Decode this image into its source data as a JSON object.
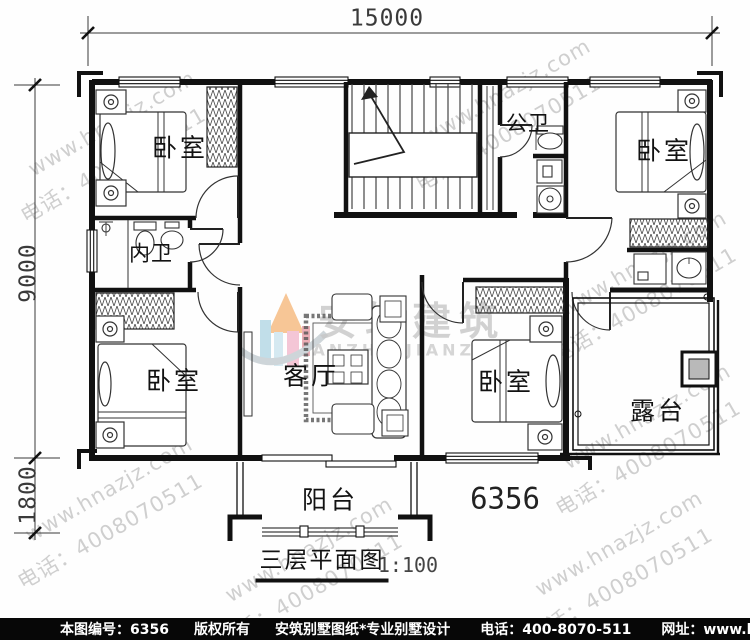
{
  "dimensions": {
    "top_width": "15000",
    "left_height": "9000",
    "left_lower": "1800"
  },
  "rooms": {
    "bedroom_top_left": "卧室",
    "bedroom_top_right": "卧室",
    "bedroom_mid_left": "卧室",
    "bedroom_bottom_right": "卧室",
    "living_room": "客厅",
    "bath_inner": "内卫",
    "bath_public": "公卫",
    "balcony": "阳台",
    "terrace": "露台"
  },
  "plan": {
    "number": "6356",
    "title": "三层平面图",
    "scale": "1:100"
  },
  "watermark": {
    "url": "www.hnazjz.com",
    "phone": "电话：4008070511",
    "brand_cn": "安筑建筑",
    "brand_en": "ANZHU JIANZHU"
  },
  "footer": {
    "doc_no": "本图编号：6356",
    "copyright": "版权所有",
    "studio": "安筑别墅图纸*专业别墅设计",
    "phone": "电话：400-8070-511",
    "website": "网址：www.hnazjz.com"
  },
  "colors": {
    "wall": "#111111",
    "footer_bg": "#070707",
    "watermark_gray": "#a9a9a9",
    "logo_blue": "#b7d9e6",
    "logo_pink": "#f3bdd0",
    "logo_orange": "#f6bd84",
    "column_fill": "#b9b9b9"
  }
}
